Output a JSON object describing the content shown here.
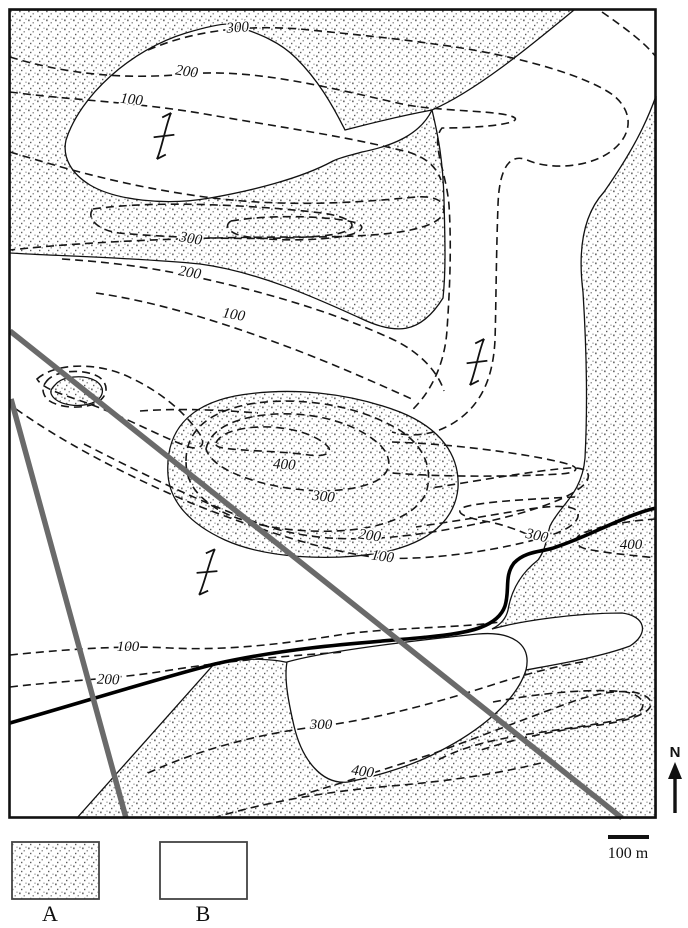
{
  "map": {
    "units": {
      "a_label": "A",
      "b_label": "B"
    },
    "contour_labels": [
      {
        "t": "300",
        "x": 238,
        "y": 32,
        "r": -4
      },
      {
        "t": "200",
        "x": 186,
        "y": 76,
        "r": 8
      },
      {
        "t": "100",
        "x": 131,
        "y": 104,
        "r": 7
      },
      {
        "t": "300",
        "x": 190,
        "y": 243,
        "r": 10
      },
      {
        "t": "200",
        "x": 189,
        "y": 277,
        "r": 10
      },
      {
        "t": "100",
        "x": 233,
        "y": 319,
        "r": 10
      },
      {
        "t": "400",
        "x": 284,
        "y": 469,
        "r": 4
      },
      {
        "t": "300",
        "x": 323,
        "y": 501,
        "r": 6
      },
      {
        "t": "200",
        "x": 369,
        "y": 540,
        "r": 8
      },
      {
        "t": "100",
        "x": 382,
        "y": 561,
        "r": 8
      },
      {
        "t": "300",
        "x": 536,
        "y": 540,
        "r": 12
      },
      {
        "t": "400",
        "x": 631,
        "y": 549,
        "r": 0
      },
      {
        "t": "100",
        "x": 128,
        "y": 651,
        "r": 0
      },
      {
        "t": "200",
        "x": 108,
        "y": 684,
        "r": 2
      },
      {
        "t": "300",
        "x": 321,
        "y": 729,
        "r": 0
      },
      {
        "t": "400",
        "x": 362,
        "y": 776,
        "r": 8
      }
    ]
  },
  "legend": {
    "a_label": "A",
    "b_label": "B"
  },
  "scale": {
    "label": "100 m"
  },
  "north": {
    "label": "N"
  },
  "colors": {
    "line": "#111111",
    "fault_gray": "#6a6a6a",
    "stipple_dot": "#777777"
  }
}
